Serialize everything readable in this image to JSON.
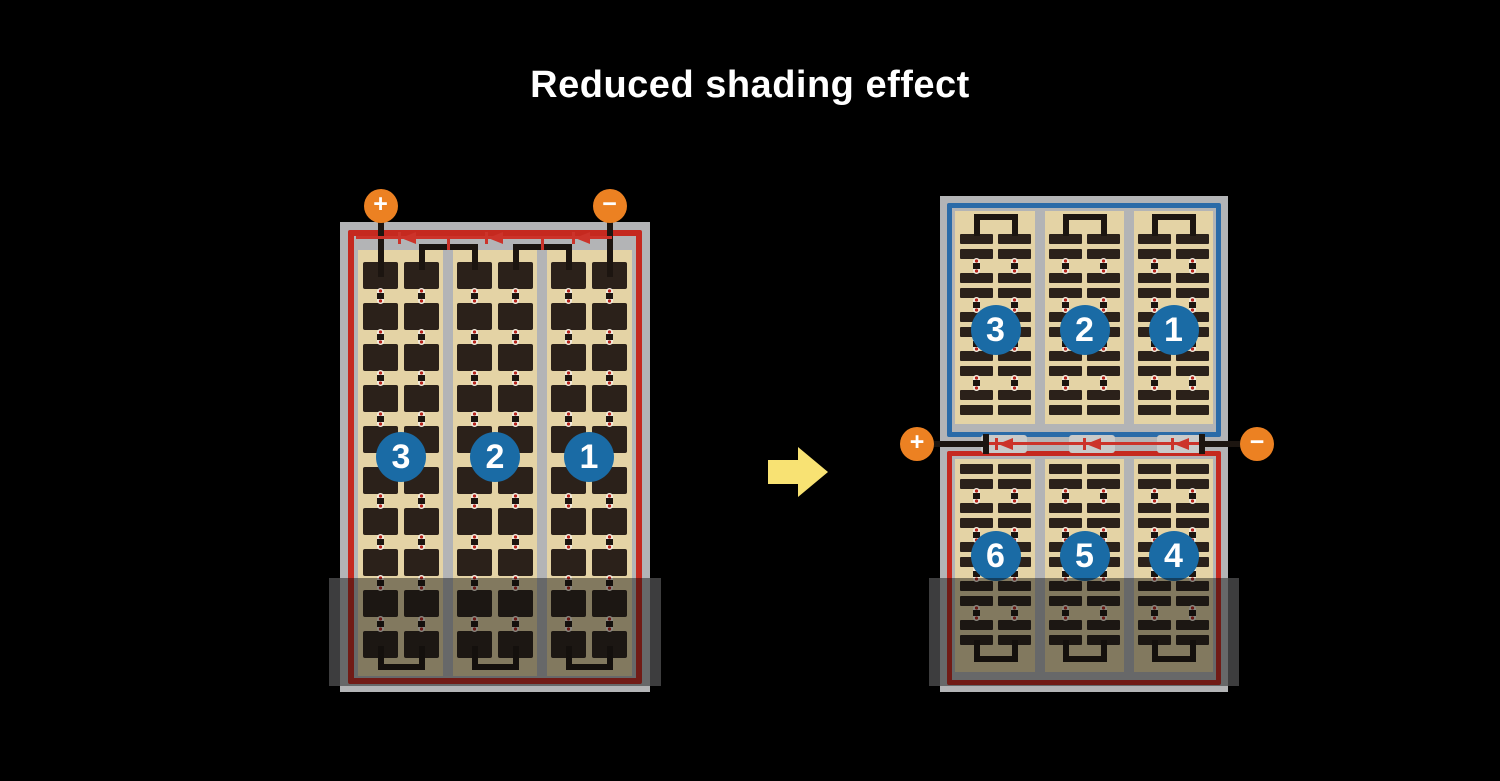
{
  "title": "Reduced shading effect",
  "arrow": {
    "direction": "right"
  },
  "colors": {
    "background": "#000000",
    "title_text": "#ffffff",
    "gray": "#b3b4b6",
    "tan": "#e4d3a5",
    "cell": "#2b211a",
    "wire": "#1c1510",
    "red": "#c5291f",
    "line_red": "#cc332a",
    "blue": "#2b6ba8",
    "circle_blue": "#1a6ba5",
    "orange": "#ec8122",
    "yellow": "#f8e273",
    "marker_white": "#f1ecdf",
    "dot_red": "#b6231c",
    "shade": "rgba(12,12,12,0.45)",
    "wing": "#3d3d3e",
    "package_gray": "#c9cac9"
  },
  "left_module": {
    "terminals": {
      "positive": "+",
      "negative": "−"
    },
    "strings": [
      {
        "number": "3"
      },
      {
        "number": "2"
      },
      {
        "number": "1"
      }
    ],
    "bypass_diode_count": 3,
    "cell_grid": {
      "columns": 6,
      "rows": 10
    },
    "shaded_bottom": true
  },
  "right_module": {
    "terminals": {
      "positive": "+",
      "negative": "−"
    },
    "top_half": {
      "strings": [
        {
          "number": "3"
        },
        {
          "number": "2"
        },
        {
          "number": "1"
        }
      ]
    },
    "bottom_half": {
      "strings": [
        {
          "number": "6"
        },
        {
          "number": "5"
        },
        {
          "number": "4"
        }
      ]
    },
    "bypass_diode_count": 3,
    "shaded_bottom": true
  }
}
